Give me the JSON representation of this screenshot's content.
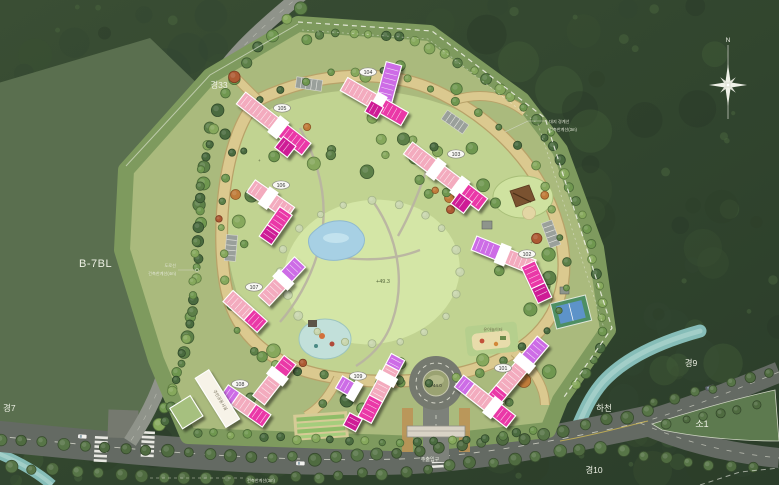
{
  "map": {
    "parcel_label": "B-7BL",
    "roads": {
      "gyeong33": "경33",
      "gyeong7": "경7",
      "gyeong9": "경9",
      "gyeong10": "경10",
      "so1": "소1"
    },
    "stream_label": "하천",
    "entrance_label": "주출입구",
    "compass_north": "N",
    "elevations": {
      "park": "+49.3",
      "roundabout": "+44.0"
    },
    "annotations": {
      "site_boundary": "대지 경계선",
      "building_limit_3m_top": "건축한계선(3m)",
      "road_line": "도로선",
      "building_limit_4m": "건축한계선(4m)",
      "building_limit_3m_bottom": "건축한계선(3m)"
    },
    "facilities": {
      "toddler_playground": "유아놀이터",
      "community_facility": "주민공동시설"
    },
    "plus_mark": "+",
    "colors": {
      "apartment_pink": "#f3abbe",
      "apartment_magenta": "#ea37a7",
      "apartment_violet": "#cd6ce6",
      "park_lawn": "#d4e6a6",
      "pond_blue": "#a7d0e4",
      "internal_road_tan": "#dbc98f",
      "forest_green": "#33462f"
    },
    "buildings": [
      {
        "id": "101"
      },
      {
        "id": "102"
      },
      {
        "id": "103"
      },
      {
        "id": "104"
      },
      {
        "id": "105"
      },
      {
        "id": "106"
      },
      {
        "id": "107"
      },
      {
        "id": "108"
      },
      {
        "id": "109"
      }
    ]
  }
}
